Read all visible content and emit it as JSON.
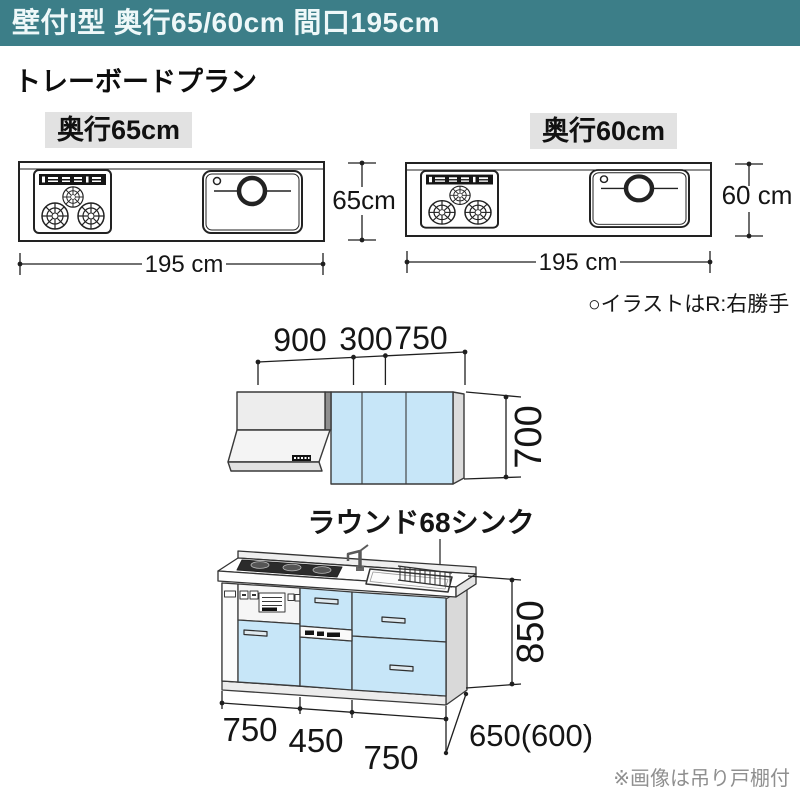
{
  "header": {
    "title": "壁付I型 奥行65/60cm 間口195cm"
  },
  "plan_title": "トレーボードプラン",
  "plan_views": {
    "left": {
      "label": "奥行65cm",
      "depth": "65cm",
      "width": "195 cm"
    },
    "right": {
      "label": "奥行60cm",
      "depth": "60 cm",
      "width": "195 cm"
    },
    "note": "○イラストはR:右勝手"
  },
  "elevation": {
    "sink_label": "ラウンド68シンク",
    "wall": {
      "w1": "900",
      "w2": "300",
      "w3": "750",
      "height": "700"
    },
    "base": {
      "w1": "750",
      "w2": "450",
      "w3": "750",
      "height": "850",
      "depth": "650(600)"
    },
    "note": "※画像は吊り戸棚付"
  },
  "colors": {
    "header_bg": "#3c7e88",
    "cabinet_blue": "#c7e6f8",
    "label_bg": "#e2e2e2",
    "line": "#222222",
    "note_gray": "#8f8f8f"
  }
}
